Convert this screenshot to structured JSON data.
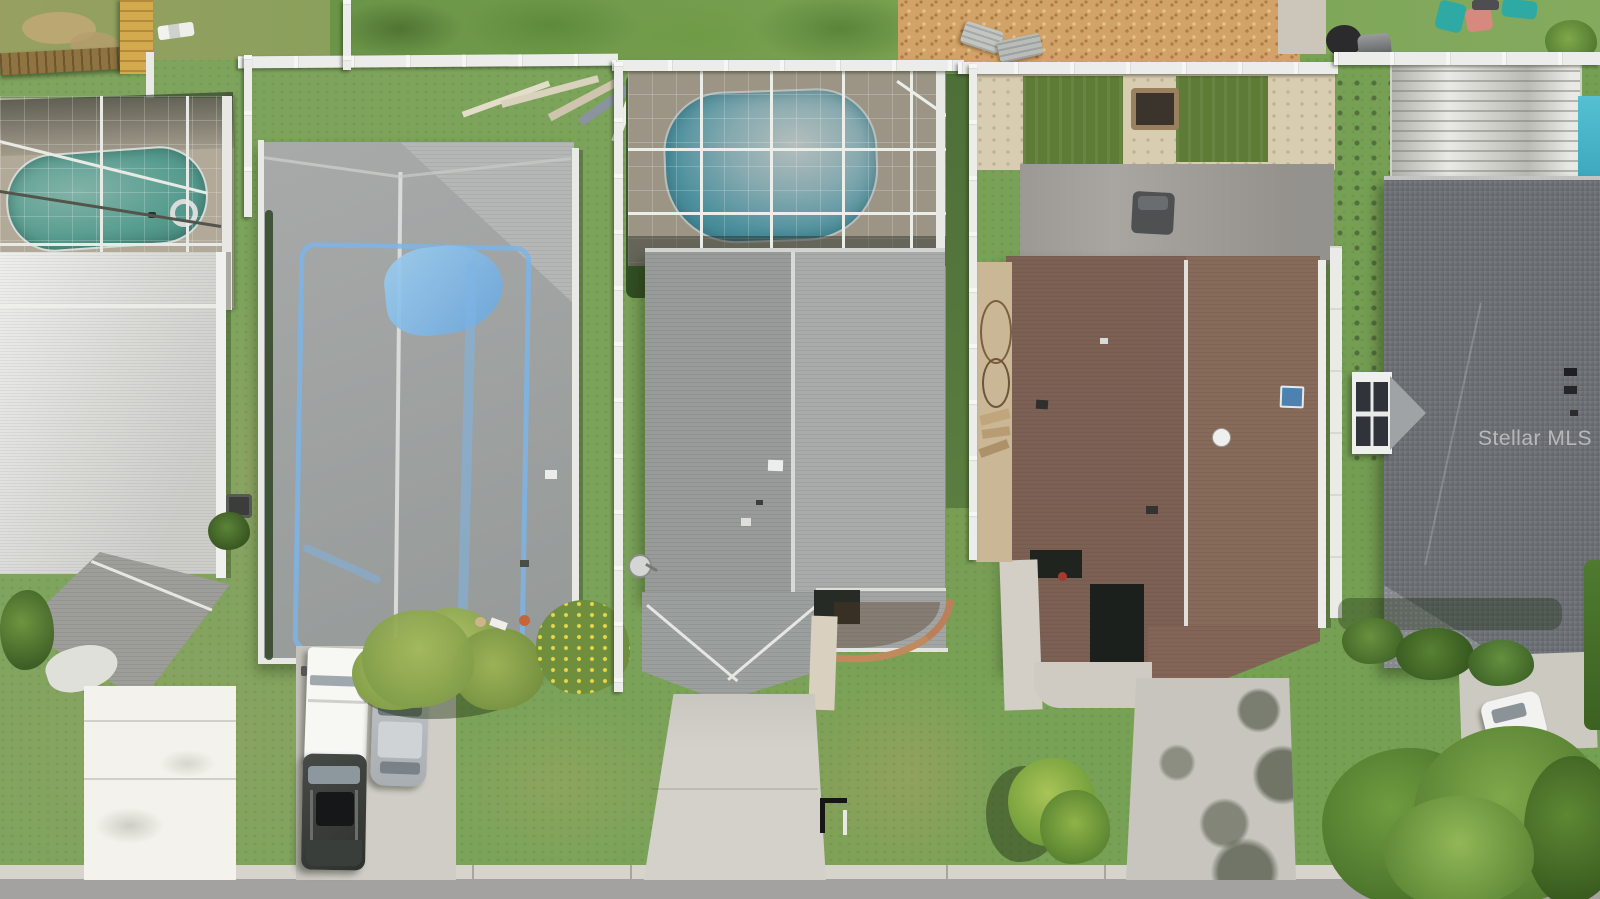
{
  "watermark": {
    "text": "Stellar MLS"
  },
  "scene": {
    "type": "aerial-drone-photo",
    "setting": "Overhead view of a suburban residential street with five adjacent single-family homes, front lawns, driveways and a road along the bottom edge",
    "objects": [
      "screened pool enclosure with teal pool and float ring (left home)",
      "white metal roof home (far left) with bright white painted driveway",
      "gray shingle roof with blue tarp repair outline (second home)",
      "white box truck, silver car and dark SUV parked in second driveway",
      "ornamental grasses and yellow flower bed",
      "center home with screened pool cage, gray shingle roof, satellite dish and curved brick garden bed",
      "black mailbox at front lawn",
      "fourth home with brown shingle roof, skylight, round vent, artificial turf backyard, gray wood deck and fire pit",
      "palm plant beside fourth driveway with tree shadows",
      "fifth home with dark gray roof, white dormer bay window, streaked white lanai roof and corner of a blue pool",
      "white car on right driveway",
      "large tree canopy in bottom right corner",
      "white vinyl privacy fences between yards, yellow wood fence top left",
      "mulch bed with lounge chairs and kids chairs in rear yards"
    ]
  },
  "palette": {
    "grass-base": "#7ca45b",
    "grass-olive": "#9aa468",
    "grass-dark": "#55783a",
    "road": "#a3a2a0",
    "curb": "#d6d4cd",
    "concrete": "#cfcdc5",
    "white-drive": "#f3f2ec",
    "roof-gray": "#9da1a0",
    "roof-gray-light": "#b0b3b1",
    "roof-white": "#dadad7",
    "roof-brown": "#7d6054",
    "roof-brown-light": "#866a5a",
    "roof-dark": "#71757a",
    "pool-teal": "#5fae9f",
    "pool-blue": "#49b0c8",
    "deck-tan": "#c6bba8",
    "fence-white": "#ecedea",
    "tarp-blue": "#7db4e6",
    "mulch": "#d2a368",
    "turf-green": "#5e7c36",
    "wood-deck": "#a9a6a1",
    "hedge-green": "#3c5830",
    "watermark": "rgba(255,255,255,0.5)"
  }
}
